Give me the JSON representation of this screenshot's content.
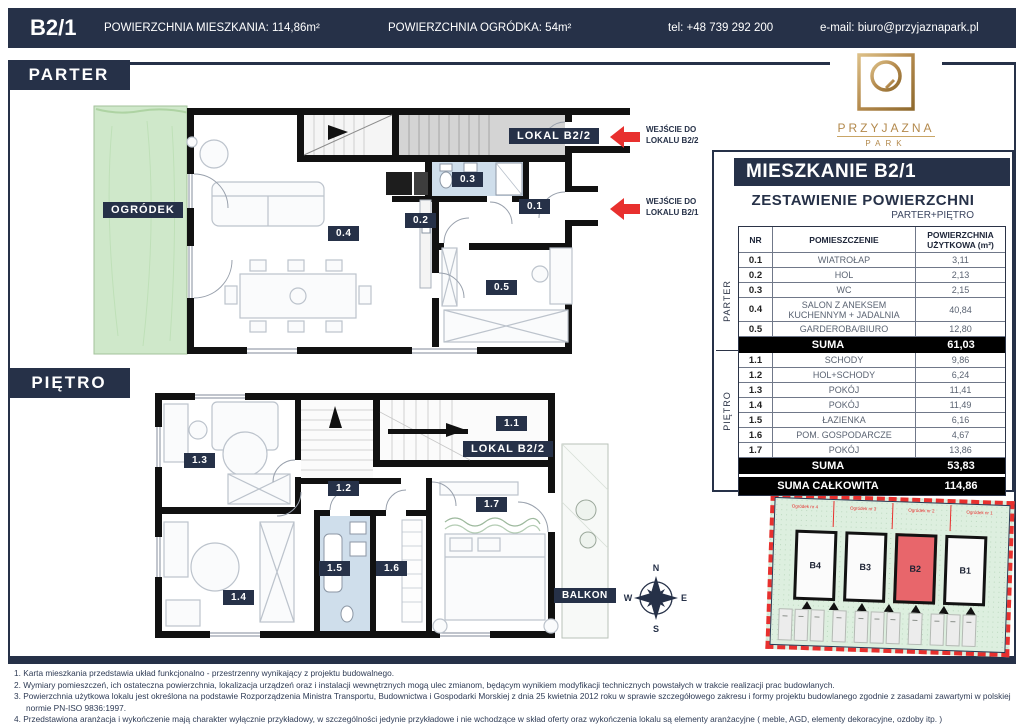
{
  "topbar": {
    "unit": "B2/1",
    "area_label": "POWIERZCHNIA MIESZKANIA: 114,86m²",
    "garden_label": "POWIERZCHNIA OGRÓDKA: 54m²",
    "phone": "tel: +48 739 292 200",
    "email": "e-mail: biuro@przyjaznapark.pl"
  },
  "logo": {
    "name": "PRZYJAZNA",
    "sub": "PARK"
  },
  "floors": {
    "parter": "PARTER",
    "pietro": "PIĘTRO"
  },
  "parter_plan": {
    "garden": "OGRÓDEK",
    "lokal": "LOKAL B2/2",
    "r01": "0.1",
    "r02": "0.2",
    "r03": "0.3",
    "r04": "0.4",
    "r05": "0.5",
    "entry_b22_line1": "WEJŚCIE DO",
    "entry_b22_line2": "LOKALU B2/2",
    "entry_b21_line1": "WEJŚCIE DO",
    "entry_b21_line2": "LOKALU B2/1"
  },
  "pietro_plan": {
    "lokal": "LOKAL B2/2",
    "balkon": "BALKON",
    "r11": "1.1",
    "r12": "1.2",
    "r13": "1.3",
    "r14": "1.4",
    "r15": "1.5",
    "r16": "1.6",
    "r17": "1.7"
  },
  "compass": {
    "n": "N",
    "e": "E",
    "s": "S",
    "w": "W"
  },
  "panel": {
    "title": "MIESZKANIE B2/1",
    "subtitle": "ZESTAWIENIE POWIERZCHNI",
    "subtitle2": "PARTER+PIĘTRO",
    "col_nr": "NR",
    "col_room": "POMIESZCZENIE",
    "col_area": "POWIERZCHNIA UŻYTKOWA (m²)",
    "side_parter": "PARTER",
    "side_pietro": "PIĘTRO",
    "parter_rows": [
      [
        "0.1",
        "WIATROŁAP",
        "3,11"
      ],
      [
        "0.2",
        "HOL",
        "2,13"
      ],
      [
        "0.3",
        "WC",
        "2,15"
      ],
      [
        "0.4",
        "SALON Z ANEKSEM KUCHENNYM + JADALNIA",
        "40,84"
      ],
      [
        "0.5",
        "GARDEROBA/BIURO",
        "12,80"
      ]
    ],
    "parter_sum_label": "SUMA",
    "parter_sum": "61,03",
    "pietro_rows": [
      [
        "1.1",
        "SCHODY",
        "9,86"
      ],
      [
        "1.2",
        "HOL+SCHODY",
        "6,24"
      ],
      [
        "1.3",
        "POKÓJ",
        "11,41"
      ],
      [
        "1.4",
        "POKÓJ",
        "11,49"
      ],
      [
        "1.5",
        "ŁAZIENKA",
        "6,16"
      ],
      [
        "1.6",
        "POM. GOSPODARCZE",
        "4,67"
      ],
      [
        "1.7",
        "POKÓJ",
        "13,86"
      ]
    ],
    "pietro_sum_label": "SUMA",
    "pietro_sum": "53,83",
    "total_label": "SUMA CAŁKOWITA",
    "total": "114,86"
  },
  "siteplan": {
    "gardens": [
      "Ogródek nr 4",
      "Ogródek nr 3",
      "Ogródek nr 2",
      "Ogródek nr 1"
    ],
    "units": [
      "B4",
      "B3",
      "B2",
      "B1"
    ],
    "highlight": "B2"
  },
  "footnotes": [
    "1. Karta mieszkania przedstawia układ funkcjonalno - przestrzenny wynikający z projektu budowalnego.",
    "2. Wymiary pomieszczeń, ich ostateczna powierzchnia, lokalizacja urządzeń oraz i instalacji wewnętrznych mogą ulec zmianom, będącym wynikiem modyfikacji technicznych powstałych w trakcie realizacji prac budowlanych.",
    "3. Powierzchnia użytkowa lokalu jest określona na podstawie Rozporządzenia Ministra Transportu, Budownictwa i Gospodarki Morskiej z dnia 25 kwietnia 2012 roku w sprawie szczegółowego zakresu i formy projektu budowlanego zgodnie z zasadami zawartymi w polskiej normie PN-ISO 9836:1997.",
    "4. Przedstawiona aranżacja i wykończenie mają charakter wyłącznie przykładowy, w szczególności jedynie przykładowe i nie wchodzące w skład oferty oraz wykończenia lokalu są elementy aranżacyjne ( meble, AGD, elementy dekoracyjne, ozdoby itp. )"
  ],
  "colors": {
    "navy": "#263148",
    "red": "#e8302e",
    "gold": "#b3894c",
    "garden_green": "#cfe8ca",
    "bath_blue": "#cfdeeb",
    "highlight_red": "#e8666b"
  }
}
